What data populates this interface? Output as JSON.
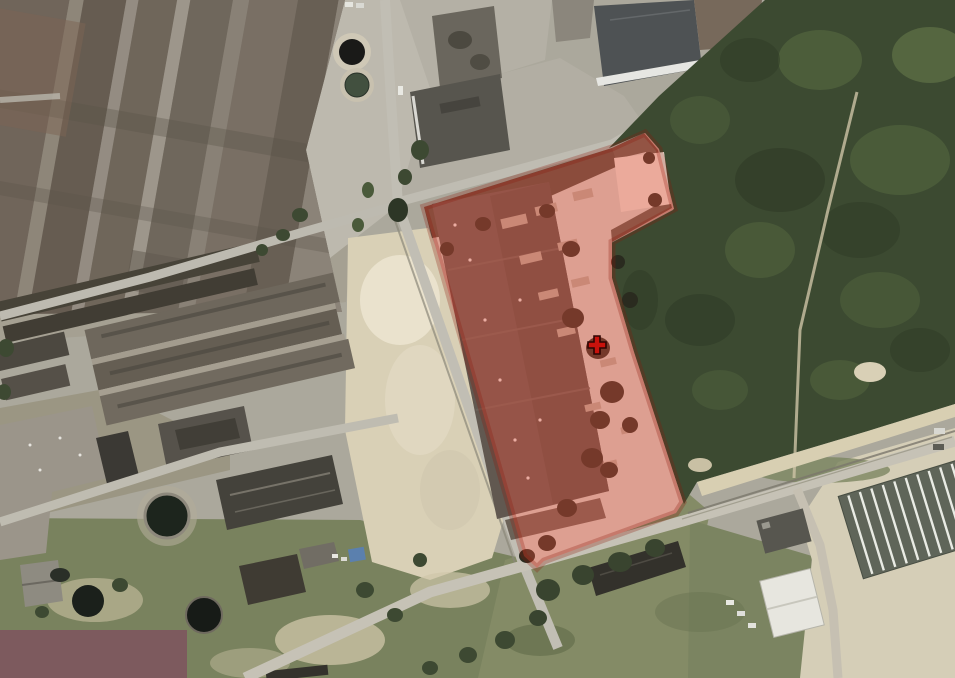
{
  "map": {
    "type": "satellite-aerial-view",
    "scene": "industrial area with warehouses, forest, sand pit and a highlighted land parcel",
    "palette": {
      "forest_green": "#3c4a31",
      "grass_green": "#79825e",
      "sand_beige": "#d9d0b6",
      "road_gray": "#c1beb4",
      "roof_gray": "#6e675c"
    }
  },
  "parcel": {
    "outline_points": "424,207 565,163 612,148 645,133 659,149 674,209 612,242 612,278 634,352 666,450 683,502 676,513 544,561 537,568 524,556",
    "overlay_fill": "rgba(230,80,60,0.40)",
    "fringe_stroke": "rgba(140,25,12,0.28)",
    "marker": {
      "shape": "cross",
      "transform": "translate(597,345)",
      "color": "#c9120c",
      "outline": "#2e0503"
    }
  },
  "redaction": {
    "color": "#7d5a5e"
  }
}
